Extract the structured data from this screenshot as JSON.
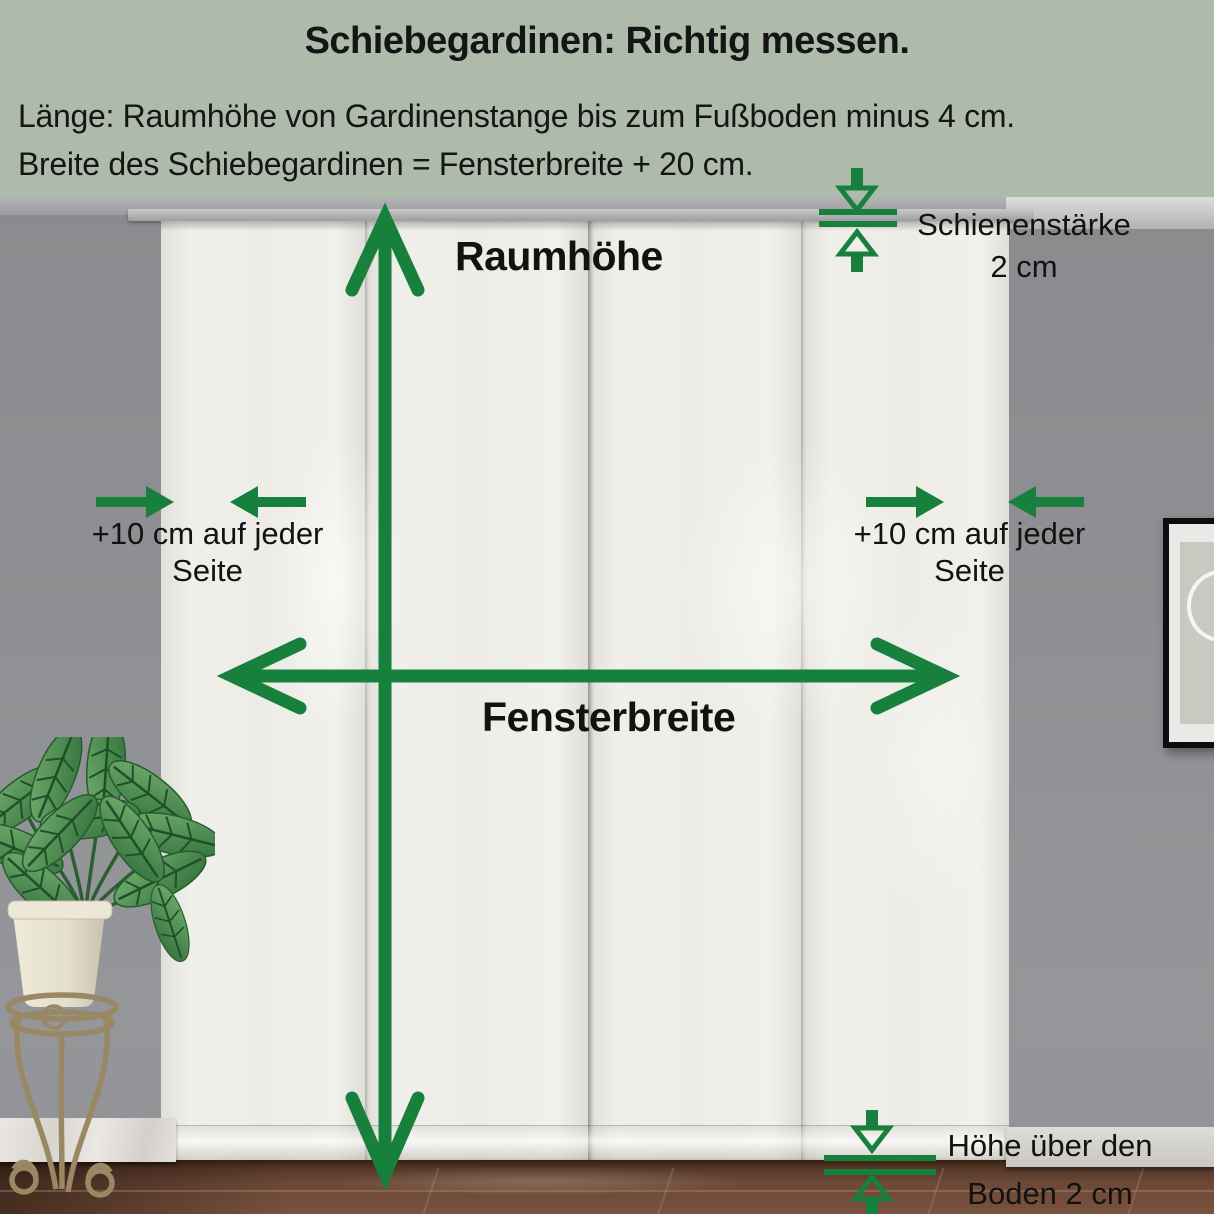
{
  "header": {
    "bg_color": "#aebbab",
    "text_color": "#151515",
    "title": "Schiebegardinen: Richtig messen.",
    "instructions": [
      "Länge: Raumhöhe von Gardinenstange bis zum Fußboden minus 4 cm.",
      "Breite des Schiebegardinen = Fensterbreite + 20 cm."
    ]
  },
  "measurements": {
    "accent_color": "#17803D",
    "room_height": {
      "label": "Raumhöhe"
    },
    "window_width": {
      "label": "Fensterbreite"
    },
    "rail_thickness": {
      "line1": "Schienenstärke",
      "line2": "2 cm"
    },
    "left_side_allowance": {
      "line1": "+10 cm auf jeder",
      "line2": "Seite"
    },
    "right_side_allowance": {
      "line1": "+10 cm auf jeder",
      "line2": "Seite"
    },
    "floor_clearance": {
      "line1": "Höhe über den",
      "line2": "Boden 2 cm"
    }
  },
  "icons": {
    "room-height-arrow-icon": "double-headed-vertical-arrow",
    "window-width-arrow-icon": "double-headed-horizontal-arrow",
    "rail-thickness-gauge-icon": "converging-vertical-arrows-with-gauge-lines",
    "left-side-arrows-icon": "converging-horizontal-arrows",
    "right-side-arrows-icon": "converging-horizontal-arrows",
    "floor-clearance-gauge-icon": "converging-vertical-arrows-with-gauge-lines"
  }
}
